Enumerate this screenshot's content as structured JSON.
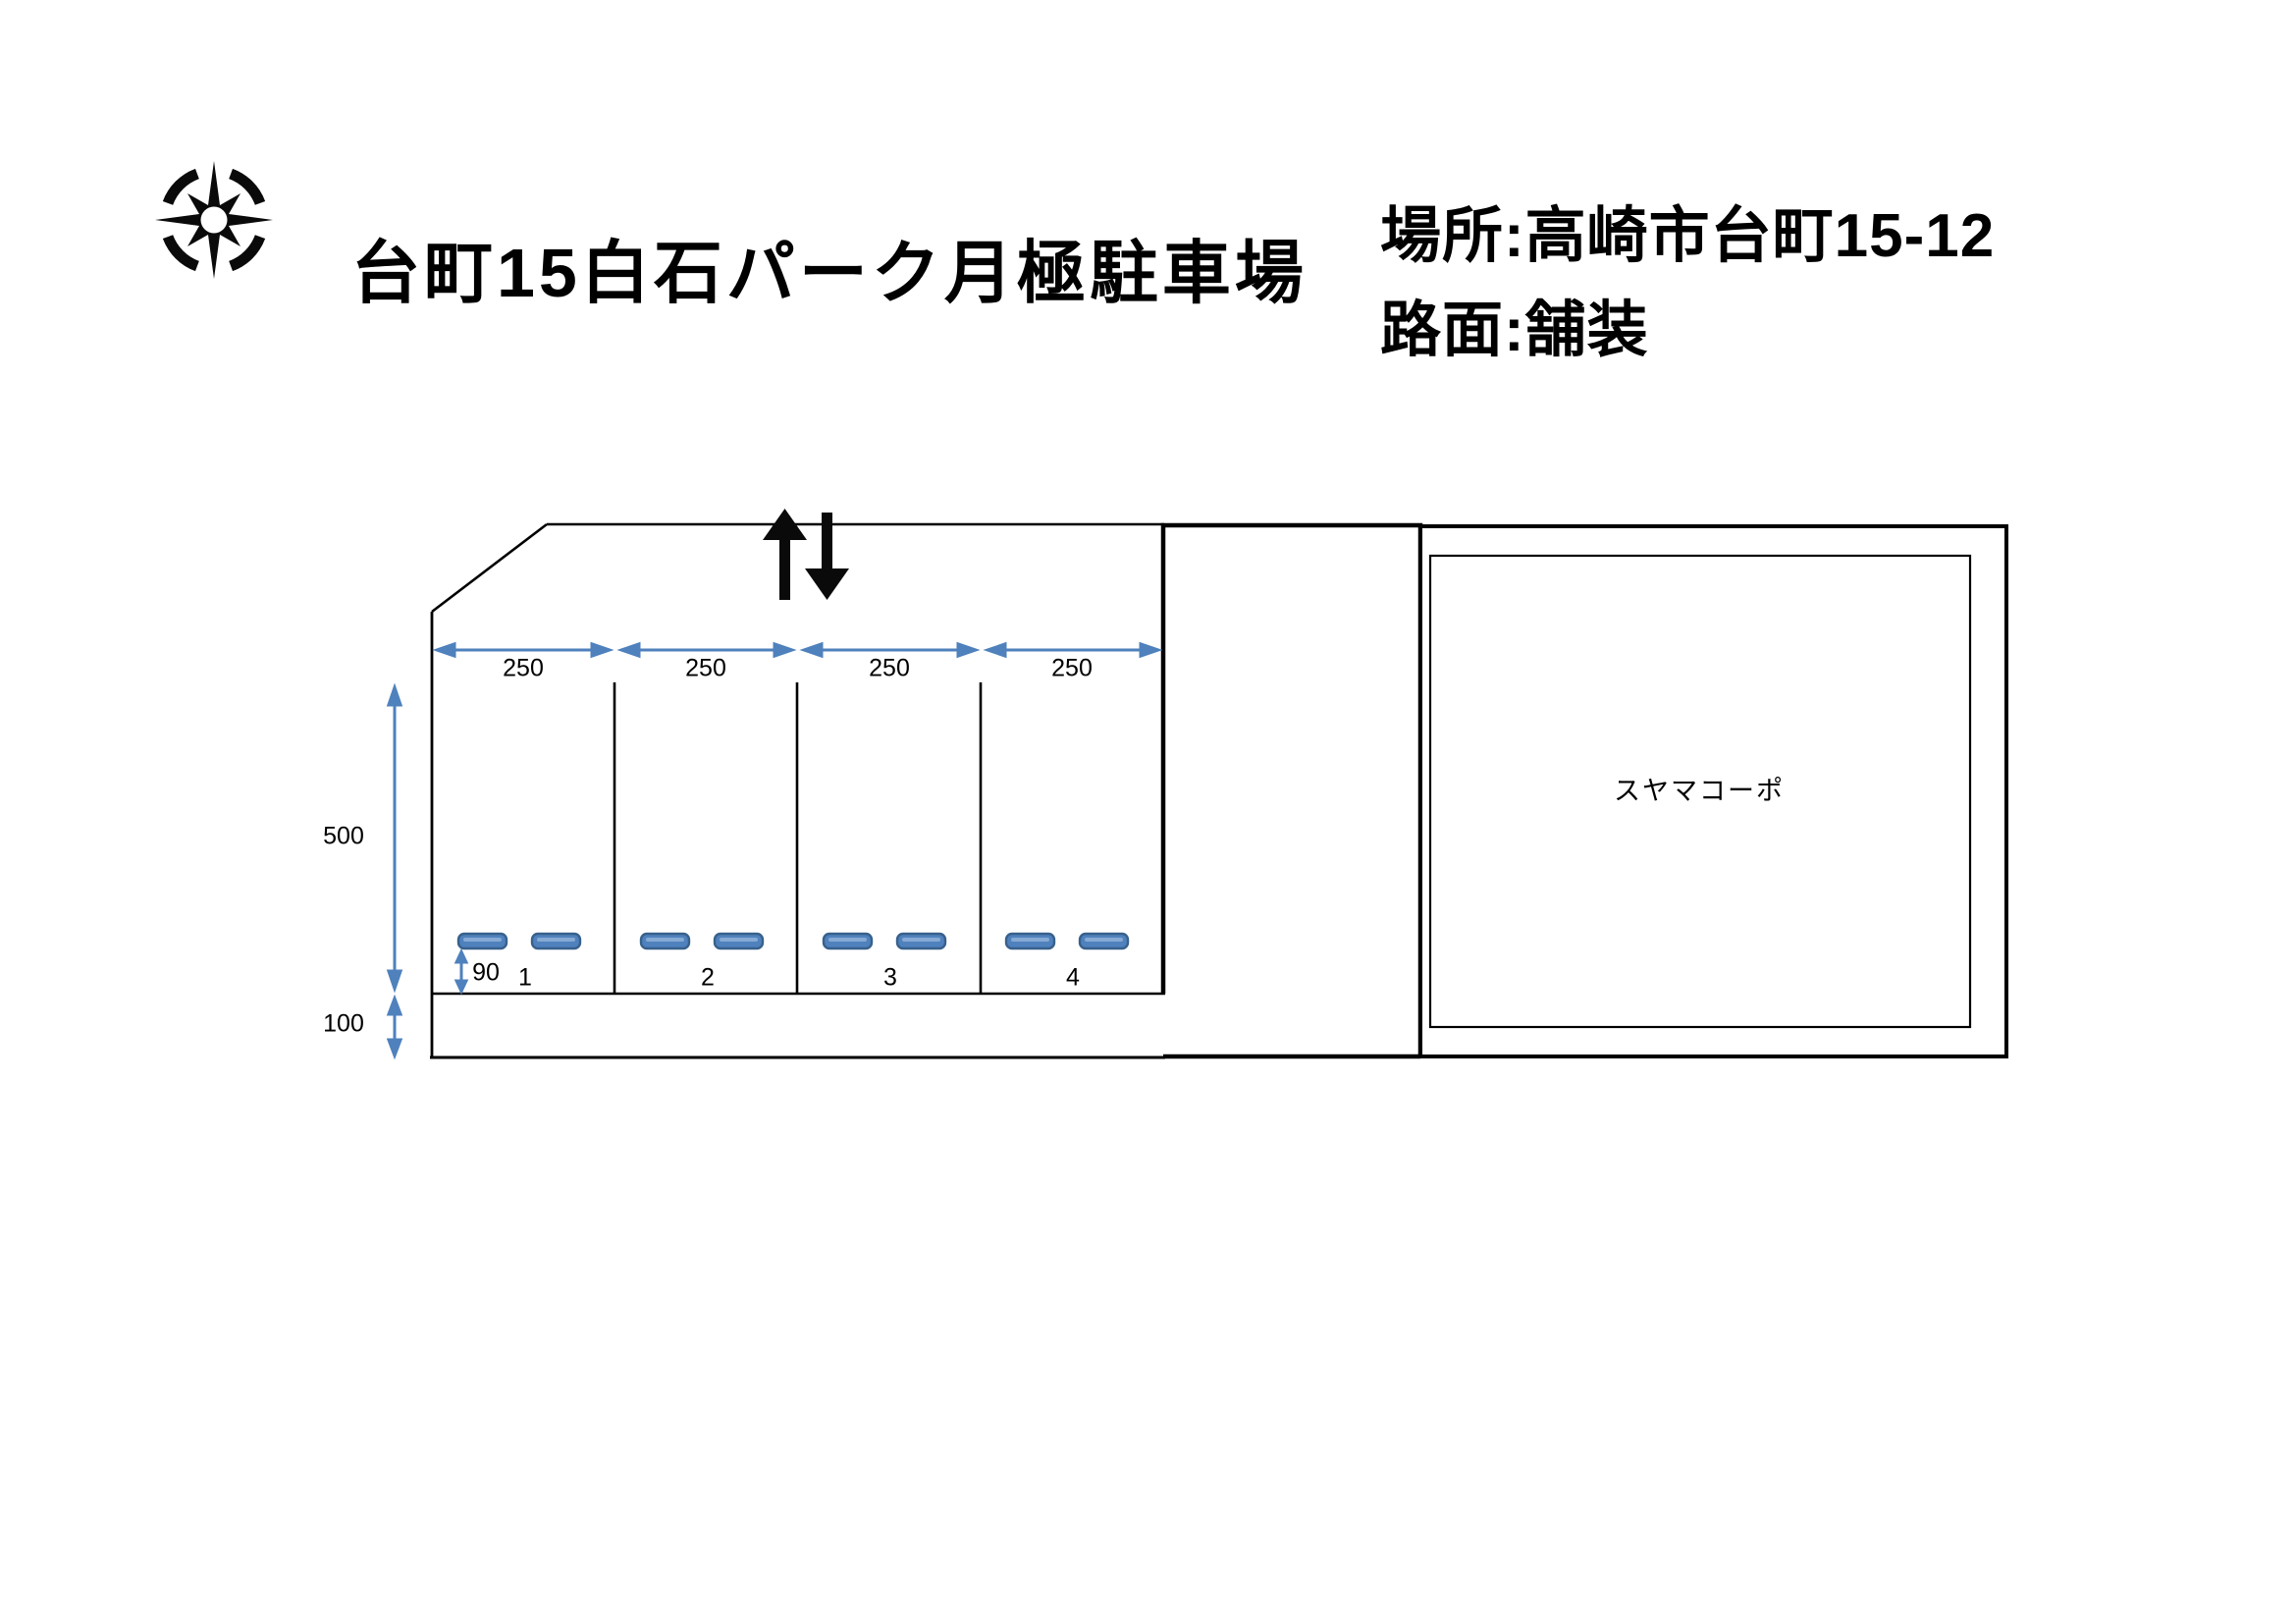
{
  "header": {
    "title": "台町15白石パーク月極駐車場",
    "location": "場所:高崎市台町15-12",
    "surface": "路面:舗装"
  },
  "diagram": {
    "building_label": "スヤマコーポ",
    "space_width_labels": [
      "250",
      "250",
      "250",
      "250"
    ],
    "depth_label": "500",
    "front_strip_label": "100",
    "stopper_offset_label": "90",
    "space_numbers": [
      "1",
      "2",
      "3",
      "4"
    ],
    "icons": {
      "compass_icon": "compass-rose",
      "entrance_arrows_icon": "up-down-arrows"
    },
    "colors": {
      "dimension_blue": "#4F81BD",
      "stopper_fill": "#4F81BD",
      "stopper_border": "#38618C",
      "line_black": "#000000"
    }
  }
}
